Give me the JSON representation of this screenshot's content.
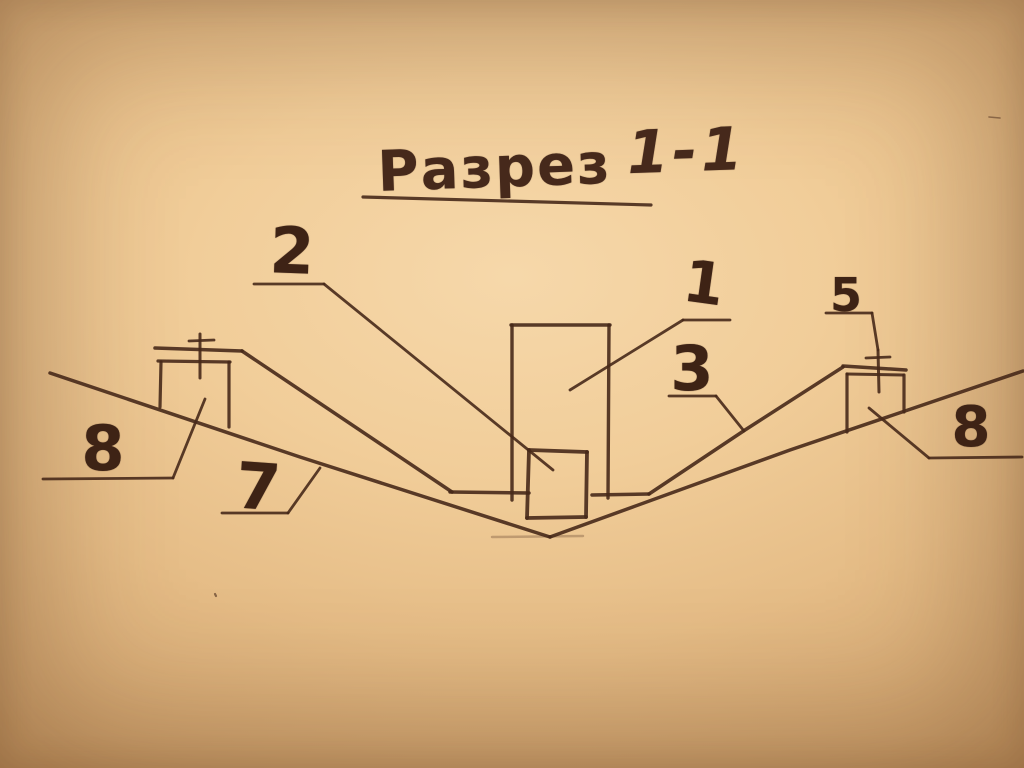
{
  "title": {
    "word": "Разрез",
    "numbers": "1-1"
  },
  "palette": {
    "paper_center": "#f6d8aa",
    "paper_edge": "#a1744a",
    "ink": "#47291a",
    "ink_digits": "#3e2315"
  },
  "labels": [
    {
      "id": "callout-1",
      "text": "1",
      "x": 704,
      "y": 283,
      "size": 58,
      "rot": 8
    },
    {
      "id": "callout-2",
      "text": "2",
      "x": 292,
      "y": 252,
      "size": 64,
      "rot": 2
    },
    {
      "id": "callout-3",
      "text": "3",
      "x": 692,
      "y": 369,
      "size": 62,
      "rot": 0
    },
    {
      "id": "callout-5",
      "text": "5",
      "x": 846,
      "y": 295,
      "size": 46,
      "rot": 0
    },
    {
      "id": "callout-7",
      "text": "7",
      "x": 258,
      "y": 488,
      "size": 64,
      "rot": 4
    },
    {
      "id": "callout-8-left",
      "text": "8",
      "x": 103,
      "y": 449,
      "size": 62,
      "rot": 0
    },
    {
      "id": "callout-8-right",
      "text": "8",
      "x": 971,
      "y": 428,
      "size": 56,
      "rot": 0
    }
  ],
  "strokes": [
    {
      "name": "ground-line-left",
      "points": [
        [
          50,
          373
        ],
        [
          300,
          457
        ],
        [
          550,
          537
        ]
      ],
      "w": 3.5
    },
    {
      "name": "ground-line-right",
      "points": [
        [
          550,
          537
        ],
        [
          790,
          450
        ],
        [
          1023,
          371
        ]
      ],
      "w": 3.5
    },
    {
      "name": "lining-berm-top-left",
      "points": [
        [
          155,
          348
        ],
        [
          242,
          351
        ]
      ],
      "w": 3.5
    },
    {
      "name": "lining-slope-left",
      "points": [
        [
          242,
          351
        ],
        [
          452,
          492
        ]
      ],
      "w": 3.5
    },
    {
      "name": "lining-floor-left",
      "points": [
        [
          450,
          492
        ],
        [
          529,
          493
        ]
      ],
      "w": 3.5
    },
    {
      "name": "lining-floor-right",
      "points": [
        [
          592,
          495
        ],
        [
          649,
          494
        ]
      ],
      "w": 3.5
    },
    {
      "name": "lining-slope-right",
      "points": [
        [
          649,
          494
        ],
        [
          745,
          430
        ],
        [
          843,
          367
        ]
      ],
      "w": 3.5
    },
    {
      "name": "lining-berm-top-right",
      "points": [
        [
          843,
          366
        ],
        [
          906,
          370
        ]
      ],
      "w": 3.5
    },
    {
      "name": "column-left-edge",
      "points": [
        [
          512,
          325
        ],
        [
          512,
          500
        ]
      ],
      "w": 3.4
    },
    {
      "name": "column-top-edge",
      "points": [
        [
          511,
          325
        ],
        [
          610,
          325
        ]
      ],
      "w": 3.4
    },
    {
      "name": "column-right-edge",
      "points": [
        [
          609,
          325
        ],
        [
          608,
          498
        ]
      ],
      "w": 3.4
    },
    {
      "name": "base-block-left-edge",
      "points": [
        [
          529,
          450
        ],
        [
          527,
          518
        ]
      ],
      "w": 3.8
    },
    {
      "name": "base-block-top-edge",
      "points": [
        [
          529,
          450
        ],
        [
          587,
          452
        ]
      ],
      "w": 3.8
    },
    {
      "name": "base-block-right-edge",
      "points": [
        [
          587,
          452
        ],
        [
          586,
          517
        ]
      ],
      "w": 3.8
    },
    {
      "name": "base-block-bottom-edge",
      "points": [
        [
          527,
          518
        ],
        [
          586,
          517
        ]
      ],
      "w": 3.8
    },
    {
      "name": "left-block-top-edge",
      "points": [
        [
          158,
          361
        ],
        [
          230,
          362
        ]
      ],
      "w": 3.2
    },
    {
      "name": "left-block-left-edge",
      "points": [
        [
          161,
          362
        ],
        [
          160,
          407
        ]
      ],
      "w": 3.2
    },
    {
      "name": "left-block-right-edge",
      "points": [
        [
          229,
          362
        ],
        [
          229,
          427
        ]
      ],
      "w": 3.2
    },
    {
      "name": "left-anchor-pin",
      "points": [
        [
          200,
          334
        ],
        [
          200,
          378
        ]
      ],
      "w": 3
    },
    {
      "name": "left-anchor-pin-bar",
      "points": [
        [
          189,
          341
        ],
        [
          214,
          340
        ]
      ],
      "w": 2.8
    },
    {
      "name": "right-block-cap-line",
      "points": [
        [
          847,
          374
        ],
        [
          903,
          375
        ]
      ],
      "w": 3
    },
    {
      "name": "right-block-left-edge",
      "points": [
        [
          847,
          374
        ],
        [
          847,
          432
        ]
      ],
      "w": 3.2
    },
    {
      "name": "right-block-right-edge",
      "points": [
        [
          904,
          375
        ],
        [
          904,
          412
        ]
      ],
      "w": 3.2
    },
    {
      "name": "right-anchor-pin",
      "points": [
        [
          878,
          350
        ],
        [
          879,
          392
        ]
      ],
      "w": 3
    },
    {
      "name": "right-anchor-pin-bar",
      "points": [
        [
          866,
          358
        ],
        [
          890,
          357
        ]
      ],
      "w": 2.8
    },
    {
      "name": "title-underline",
      "points": [
        [
          363,
          197
        ],
        [
          651,
          205
        ]
      ],
      "w": 3.2
    },
    {
      "name": "callout-1-underline",
      "points": [
        [
          683,
          320
        ],
        [
          730,
          320
        ]
      ],
      "w": 2.8
    },
    {
      "name": "callout-1-leader",
      "points": [
        [
          683,
          320
        ],
        [
          570,
          390
        ]
      ],
      "w": 2.8
    },
    {
      "name": "callout-2-underline",
      "points": [
        [
          254,
          284
        ],
        [
          324,
          284
        ]
      ],
      "w": 2.8
    },
    {
      "name": "callout-2-leader",
      "points": [
        [
          324,
          284
        ],
        [
          553,
          470
        ]
      ],
      "w": 2.8
    },
    {
      "name": "callout-3-underline",
      "points": [
        [
          669,
          396
        ],
        [
          716,
          396
        ]
      ],
      "w": 2.8
    },
    {
      "name": "callout-3-leader",
      "points": [
        [
          716,
          396
        ],
        [
          744,
          431
        ]
      ],
      "w": 2.8
    },
    {
      "name": "callout-5-underline",
      "points": [
        [
          826,
          313
        ],
        [
          872,
          313
        ]
      ],
      "w": 2.8
    },
    {
      "name": "callout-5-leader",
      "points": [
        [
          872,
          313
        ],
        [
          878,
          350
        ]
      ],
      "w": 2.8
    },
    {
      "name": "callout-7-underline",
      "points": [
        [
          222,
          513
        ],
        [
          288,
          513
        ]
      ],
      "w": 2.8
    },
    {
      "name": "callout-7-leader",
      "points": [
        [
          288,
          513
        ],
        [
          320,
          468
        ]
      ],
      "w": 2.8
    },
    {
      "name": "callout-8-left-underline",
      "points": [
        [
          43,
          479
        ],
        [
          173,
          478
        ]
      ],
      "w": 2.8
    },
    {
      "name": "callout-8-left-leader",
      "points": [
        [
          173,
          478
        ],
        [
          205,
          399
        ]
      ],
      "w": 2.8
    },
    {
      "name": "callout-8-right-underline",
      "points": [
        [
          929,
          458
        ],
        [
          1022,
          457
        ]
      ],
      "w": 2.8
    },
    {
      "name": "callout-8-right-leader",
      "points": [
        [
          929,
          458
        ],
        [
          869,
          408
        ]
      ],
      "w": 2.8
    },
    {
      "name": "vertex-shadow-line",
      "points": [
        [
          492,
          537
        ],
        [
          583,
          536
        ]
      ],
      "w": 2.5,
      "o": 0.28
    },
    {
      "name": "paper-speck-top-right",
      "points": [
        [
          989,
          117
        ],
        [
          1000,
          118
        ]
      ],
      "w": 1.6,
      "o": 0.5
    },
    {
      "name": "paper-speck-bottom-left",
      "points": [
        [
          215,
          594
        ],
        [
          216,
          596
        ]
      ],
      "w": 2.2,
      "o": 0.6
    }
  ]
}
